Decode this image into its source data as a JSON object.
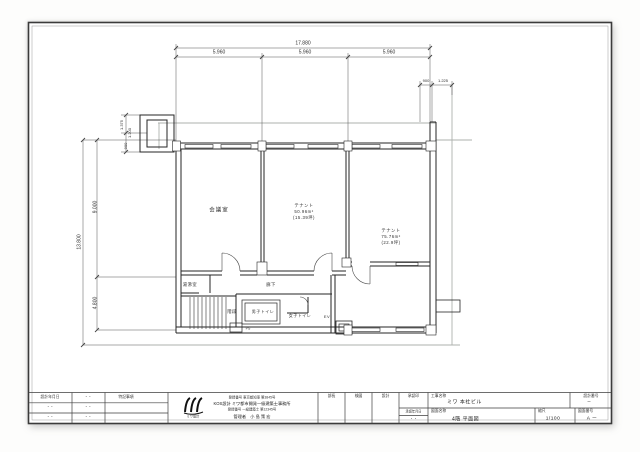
{
  "drawing": {
    "dims": {
      "top_total": "17.880",
      "top_seg_1": "5.960",
      "top_seg_2": "5.960",
      "top_seg_3": "5.960",
      "right_a": "900",
      "right_b": "1.225",
      "left_total": "13.800",
      "left_seg_top": "9.000",
      "left_seg_bottom": "4.800",
      "shaft_a": "1.375",
      "shaft_b": "1.200",
      "shaft_c": "900"
    },
    "rooms": {
      "meeting": "会議室",
      "tenant1_name": "テナント",
      "tenant1_area": "50.96m²",
      "tenant1_tsubo": "(15.39坪)",
      "tenant2_name": "テナント",
      "tenant2_area": "75.76m²",
      "tenant2_tsubo": "(22.9坪)",
      "kitchen": "湯沸室",
      "corridor": "廊下",
      "stairs": "階段",
      "mens_toilet": "男子トイレ",
      "womens_toilet": "女子トイレ",
      "elevator": "EV",
      "pipe_space": "PS"
    }
  },
  "title_block": {
    "left": {
      "r1c1": "設計年月日",
      "r1c2": "・・",
      "r1c3": "特記事項",
      "r2c1": "・・",
      "r2c2": "・・",
      "r3c1": "・・",
      "r3c2": "・・"
    },
    "firm": {
      "logo_caption": "ミワ設計",
      "line1": "登録番号 東京都知事 第3845号",
      "line2": "KOS設計 ミワ都市開発一級建築士事務所",
      "line3": "登録番号 一級建築士 第12345号",
      "line4": "管理者　小 島 策 宏"
    },
    "right": {
      "seal1": "部長",
      "seal2": "検図",
      "seal3": "設計",
      "seal4": "承認印",
      "approval_date_label": "承認年月日",
      "approval_date": "・・",
      "project_label": "工事名称",
      "project_value": "ミワ 本社ビル",
      "design_no_label": "設計番号",
      "design_no_value": "ー",
      "drawing_label": "図面名称",
      "drawing_value": "4階 平面図",
      "scale_label": "縮尺",
      "scale_value": "1/100",
      "sheet_label": "図面番号",
      "sheet_value": "A ー"
    }
  }
}
